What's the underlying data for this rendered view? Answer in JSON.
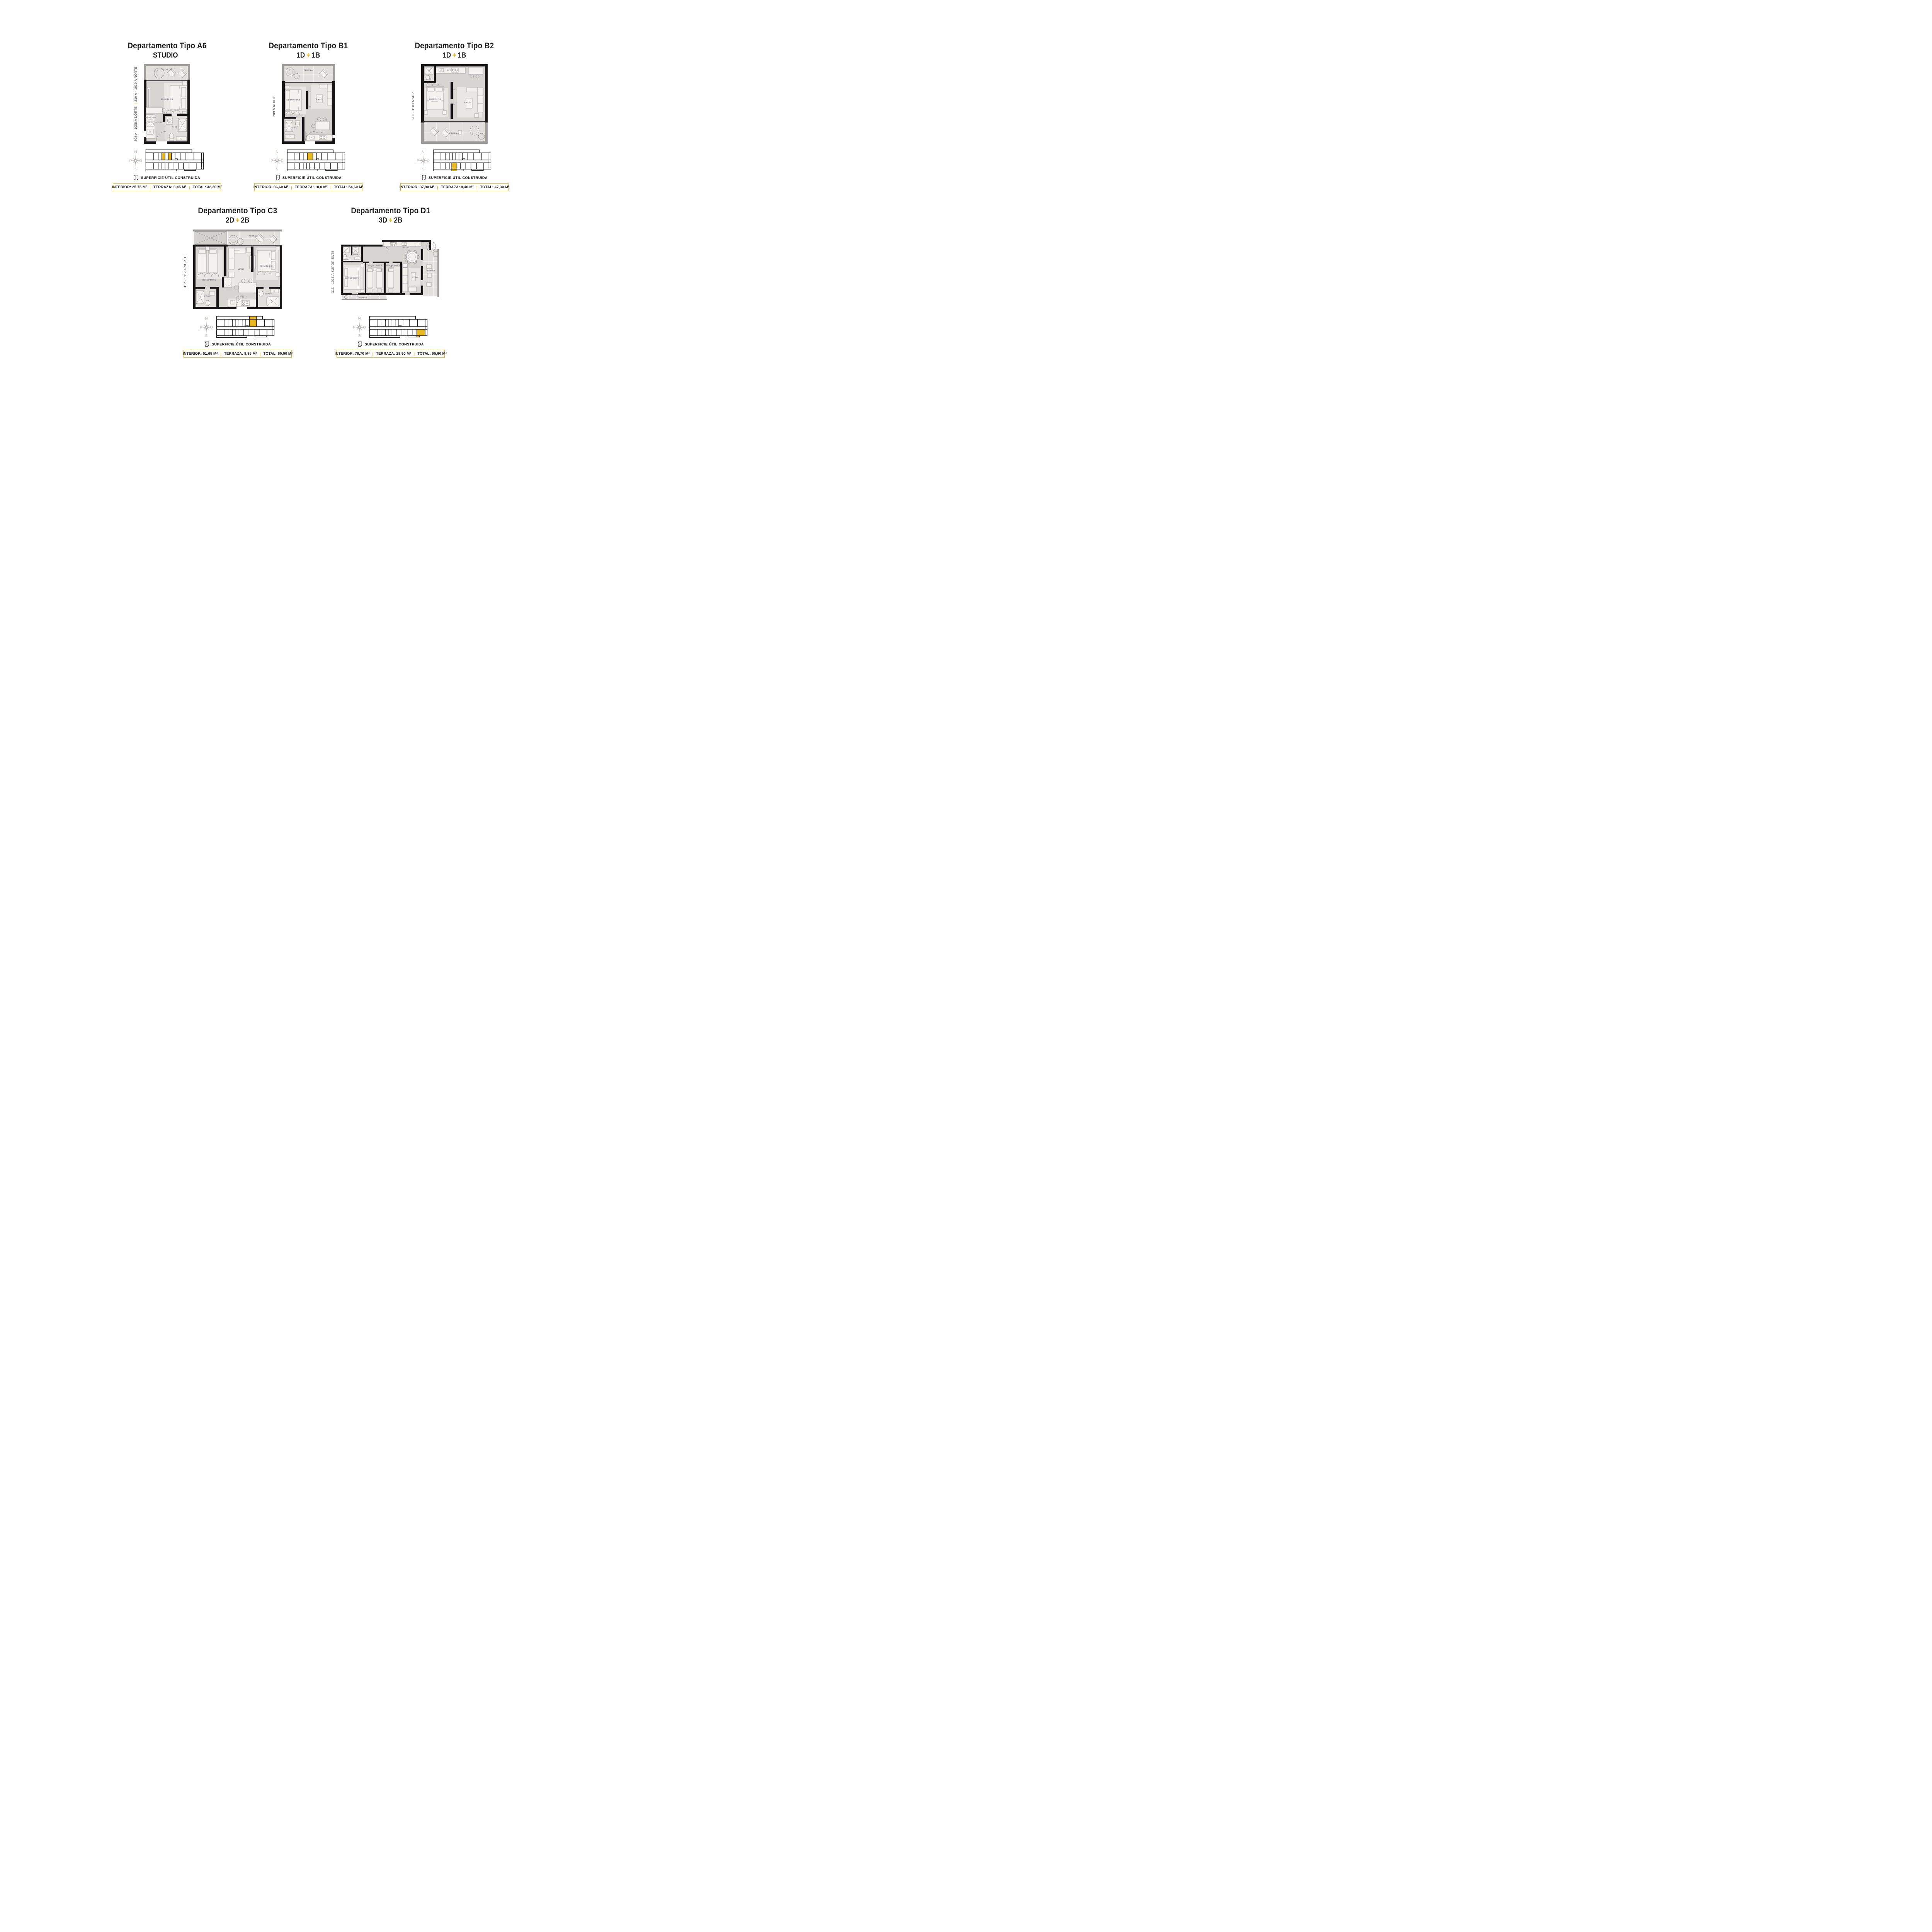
{
  "accent_color": "#E8B822",
  "separator": "|",
  "compass": {
    "north": "N",
    "south": "S",
    "west": "P",
    "east": "O"
  },
  "cards": [
    {
      "title": "Departamento Tipo A6",
      "subtitle_left": "STUDIO",
      "subtitle_plus": "",
      "subtitle_right": "",
      "unit_label_1": "308 A - 1008 A NORTE",
      "unit_label_divider": "|",
      "unit_label_2": "310 A - 1010 A NORTE",
      "legend": "SUPERFICIE ÚTIL CONSTRUIDA",
      "interior": "INTERIOR: 25,75 M²",
      "terraza": "TERRAZA: 6,45 M²",
      "total": "TOTAL: 32,20 M²",
      "annotation": "TERMO BAJO MUEBLE",
      "rooms": [
        "TERRAZA",
        "DORMITORIO",
        "COCINA",
        "BAÑO"
      ]
    },
    {
      "title": "Departamento Tipo B1",
      "subtitle_left": "1D",
      "subtitle_plus": "+",
      "subtitle_right": "1B",
      "unit_label_1": "209 A NORTE",
      "unit_label_divider": "",
      "unit_label_2": "",
      "legend": "SUPERFICIE ÚTIL CONSTRUIDA",
      "interior": "INTERIOR: 36,60 M²",
      "terraza": "TERRAZA: 18,0 M²",
      "total": "TOTAL: 54,60 M²",
      "rooms": [
        "TERRAZA",
        "DORMITORIO",
        "LIVING",
        "BAÑO",
        "COCINA"
      ]
    },
    {
      "title": "Departamento Tipo B2",
      "subtitle_left": "1D",
      "subtitle_plus": "+",
      "subtitle_right": "1B",
      "unit_label_1": "203 - 1103 A SUR",
      "unit_label_divider": "",
      "unit_label_2": "",
      "legend": "SUPERFICIE ÚTIL CONSTRUIDA",
      "interior": "INTERIOR: 37,90 M²",
      "terraza": "TERRAZA: 9,40 M²",
      "total": "TOTAL: 47,30 M²",
      "rooms": [
        "COCINA",
        "BAÑO",
        "DORMITORIO",
        "LIVING",
        "TERRAZA"
      ]
    },
    {
      "title": "Departamento Tipo C3",
      "subtitle_left": "2D",
      "subtitle_plus": "+",
      "subtitle_right": "2B",
      "unit_label_1": "312 - 1012 A NORTE",
      "unit_label_divider": "",
      "unit_label_2": "",
      "legend": "SUPERFICIE ÚTIL CONSTRUIDA",
      "interior": "INTERIOR: 51,65 M²",
      "terraza": "TERRAZA: 8,85 M²",
      "total": "TOTAL: 60,50 M²",
      "rooms": [
        "TERRAZA",
        "DORMITORIO 2",
        "LIVING",
        "DORMITORIO 1",
        "BAÑO 2",
        "COCINA",
        "BAÑO 1"
      ]
    },
    {
      "title": "Departamento Tipo D1",
      "subtitle_left": "3D",
      "subtitle_plus": "+",
      "subtitle_right": "2B",
      "unit_label_1": "315 - 1015 A SURORIENTE",
      "unit_label_divider": "",
      "unit_label_2": "",
      "legend": "SUPERFICIE ÚTIL CONSTRUIDA",
      "interior": "INTERIOR: 76,70 M²",
      "terraza": "TERRAZA: 18,90 M²",
      "total": "TOTAL: 95,60 M²",
      "rooms": [
        "COCINA",
        "BAÑO 2",
        "BAÑO 1",
        "DORMITORIO 1",
        "DORMITORIO 2",
        "DORMITORIO 3",
        "LIVING",
        "TERRAZA",
        "TERRAZA"
      ]
    }
  ]
}
